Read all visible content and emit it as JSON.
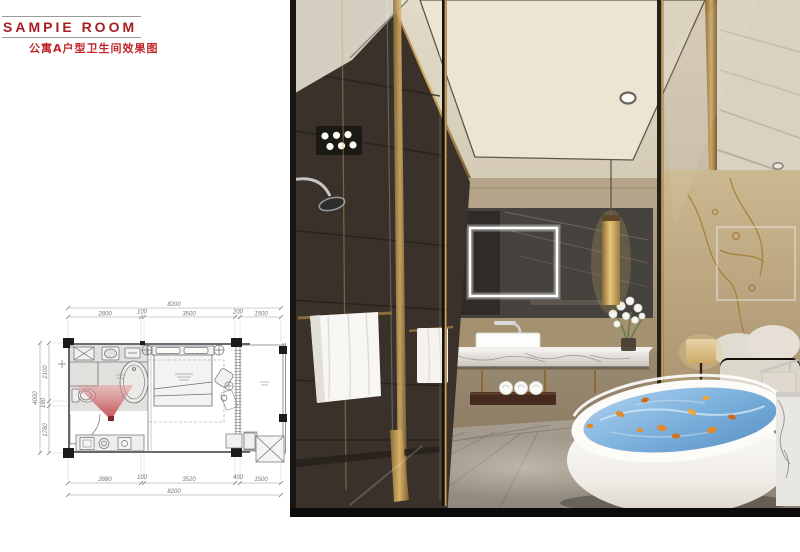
{
  "logo": {
    "title": "SAMPIE ROOM",
    "subtitle": "公寓A户型卫生间效果图"
  },
  "floor_plan": {
    "dims_top": {
      "total": "8200",
      "segments": [
        "2800",
        "100",
        "3500",
        "200",
        "1500"
      ]
    },
    "dims_bottom": {
      "total": "8200",
      "segments": [
        "2880",
        "100",
        "3520",
        "400",
        "1500"
      ]
    },
    "dims_left": {
      "total": "4000",
      "segments": [
        "2100",
        "180",
        "1780"
      ]
    }
  },
  "colors": {
    "logo_red": "#a81e24",
    "subtitle_red": "#c1272d",
    "view_cone_red": "#c43a42",
    "brass_gold": "#b08d57",
    "water_blue": "#6fa8d8",
    "plan_line_gray": "#76767e"
  }
}
